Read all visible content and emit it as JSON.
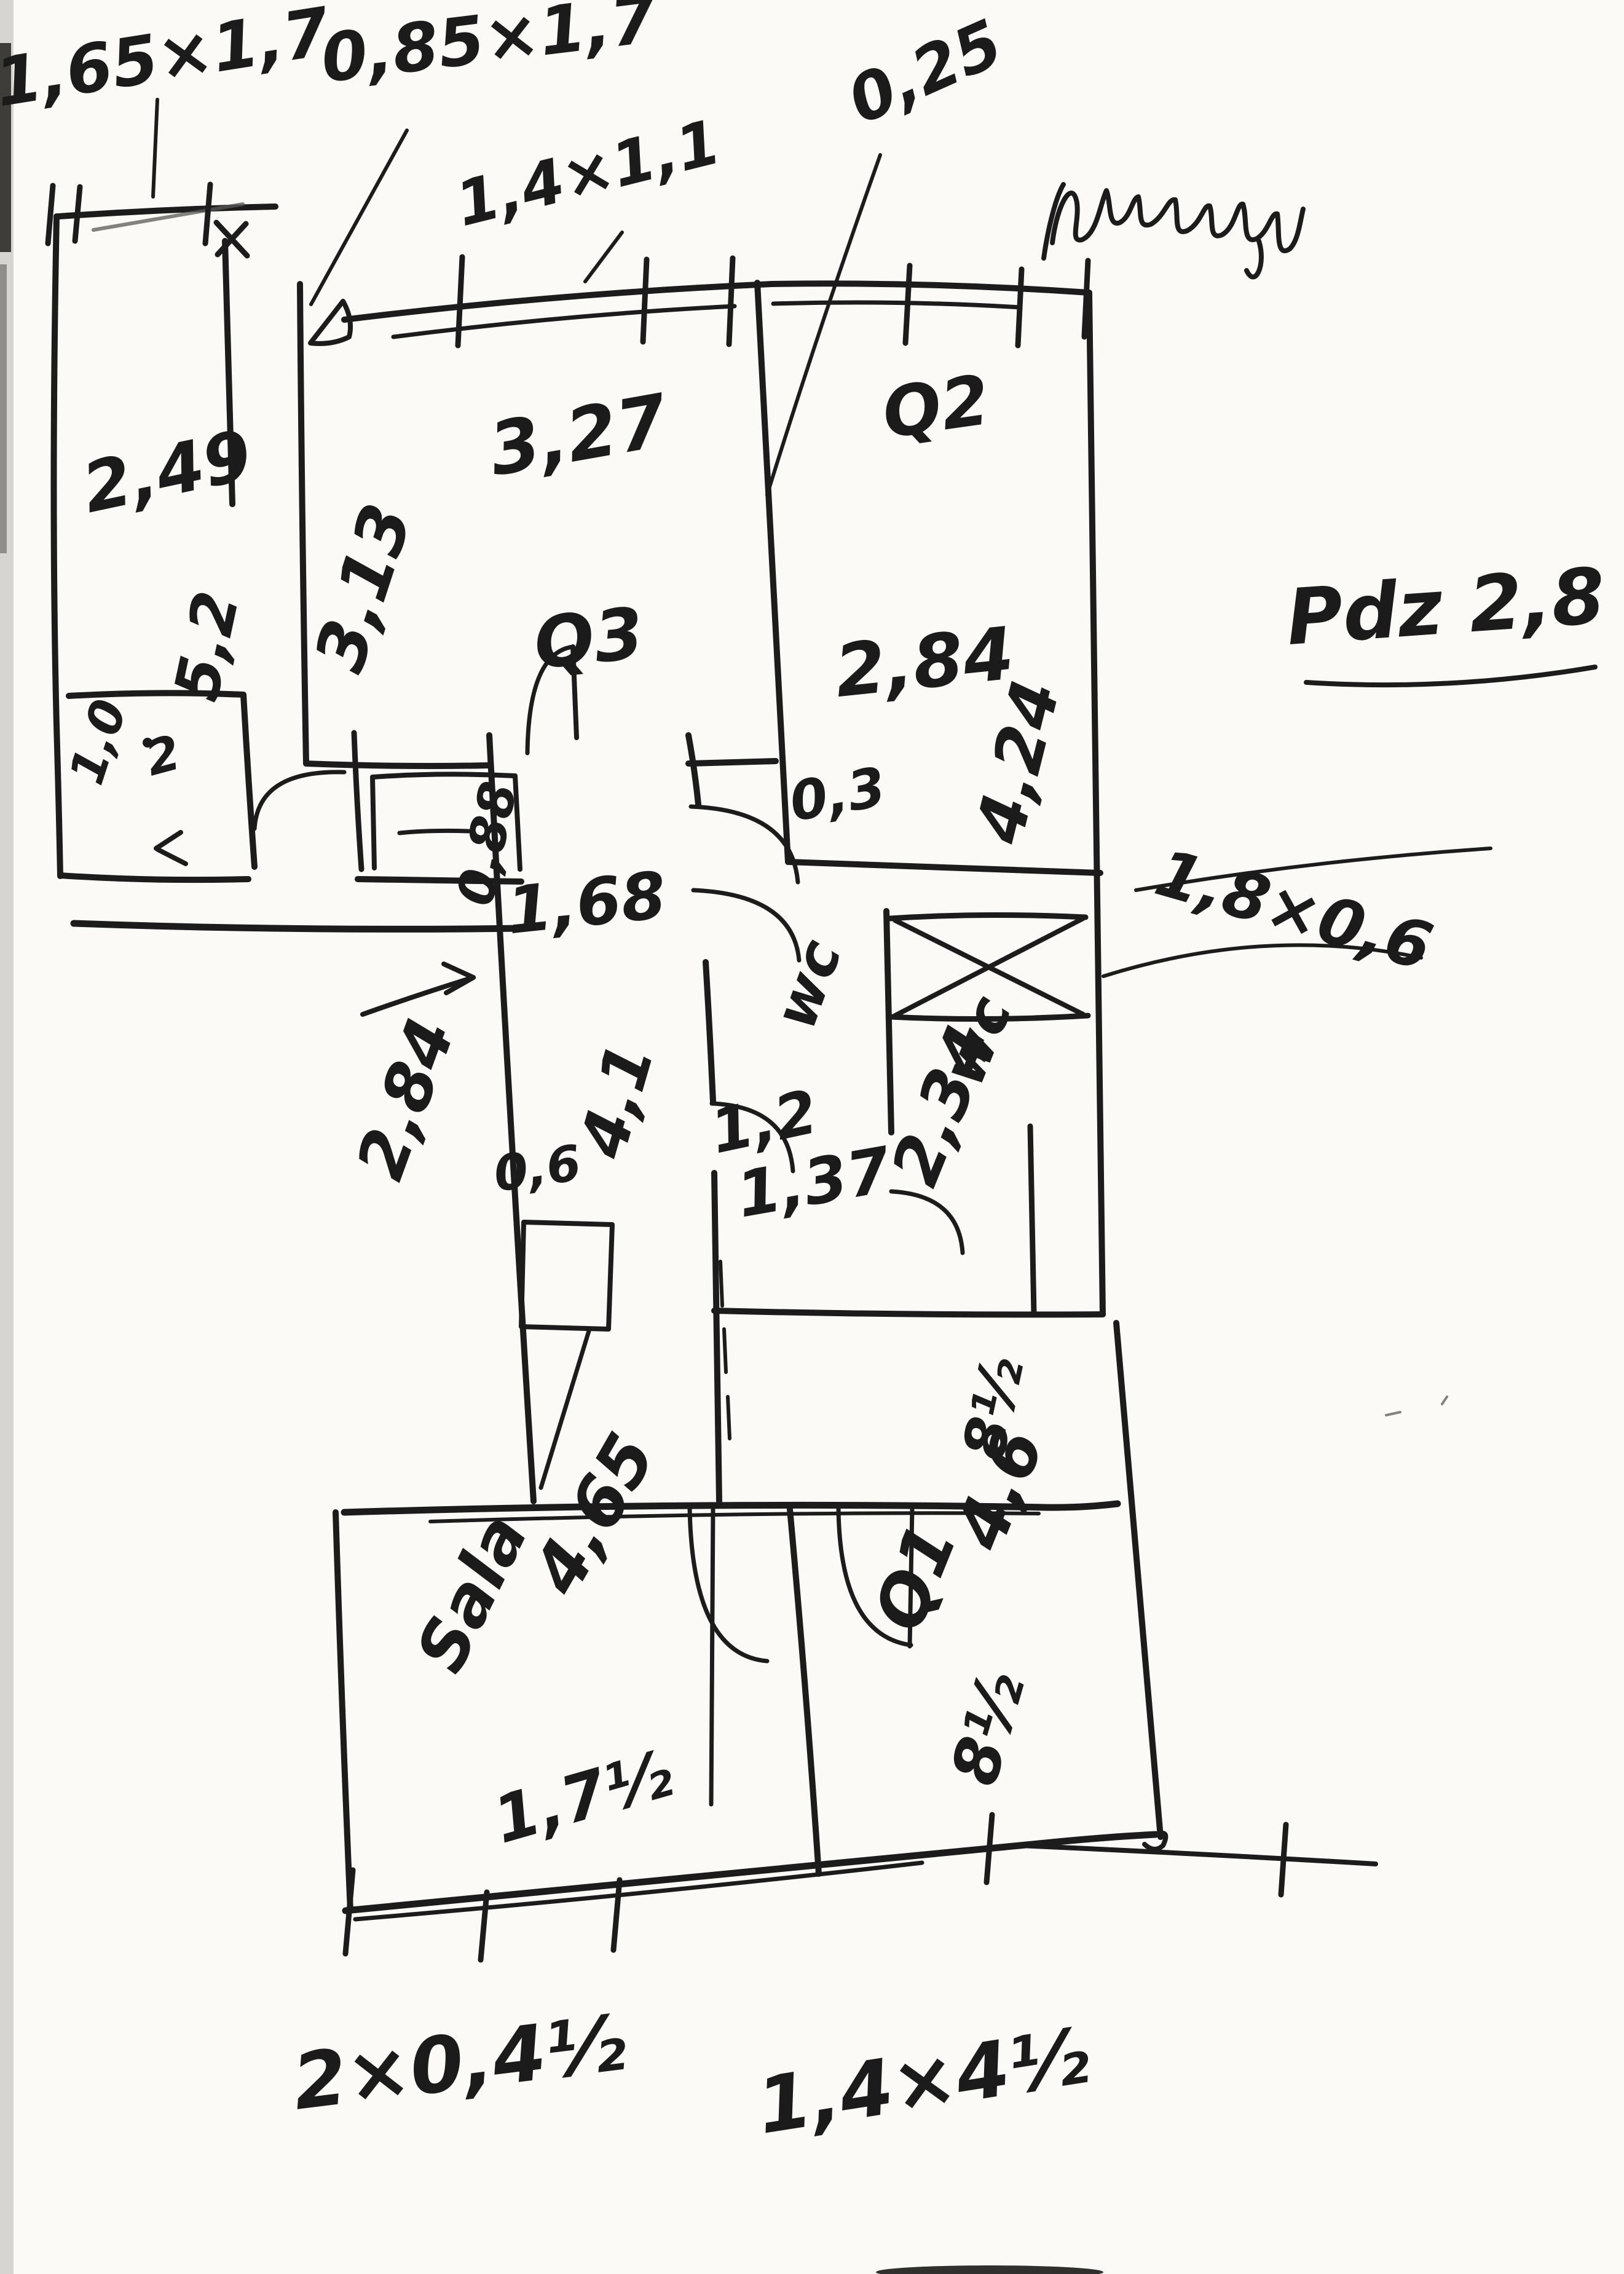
{
  "sketch": {
    "paper_color": "#fbfaf7",
    "ink_color": "#1c1c1c",
    "annotations": {
      "window_left": "1,65×1,7",
      "window_hall": "0,85×1,7",
      "window_room3": "1,4×1,1",
      "wall_thickness": "0,25",
      "scribble_transcription": "(nieczytelne)",
      "height_note": "Pdz 2,8",
      "transom_window": "1,8×0,6",
      "bottom_left": "2×0,4½",
      "bottom_right": "1,4×4½"
    },
    "rooms": {
      "top_left": {
        "width": "2,49",
        "depth": "5,2"
      },
      "balcony": {
        "w": "1,0",
        "d": "2"
      },
      "room3": {
        "name": "Q3",
        "width": "3,27",
        "depth": "3,13"
      },
      "room2": {
        "name": "Q2",
        "width": "2,84",
        "depth": "4,24"
      },
      "corridor": {
        "width": "1,68",
        "length": "4,1",
        "left_dim": "2,84",
        "entry": "0,88",
        "stub": "0,3",
        "cupboard": "0,6"
      },
      "wc_small": {
        "name": "wc",
        "width": "1,2",
        "lobby": "1,37"
      },
      "wc_big": {
        "name": "wc",
        "length": "2,34",
        "extra": "8½"
      },
      "sala": {
        "name": "Sala",
        "width": "4,65",
        "extra": "1,7½"
      },
      "room1": {
        "name": "Q1",
        "depth": "4,6",
        "extra": "8½"
      }
    }
  }
}
